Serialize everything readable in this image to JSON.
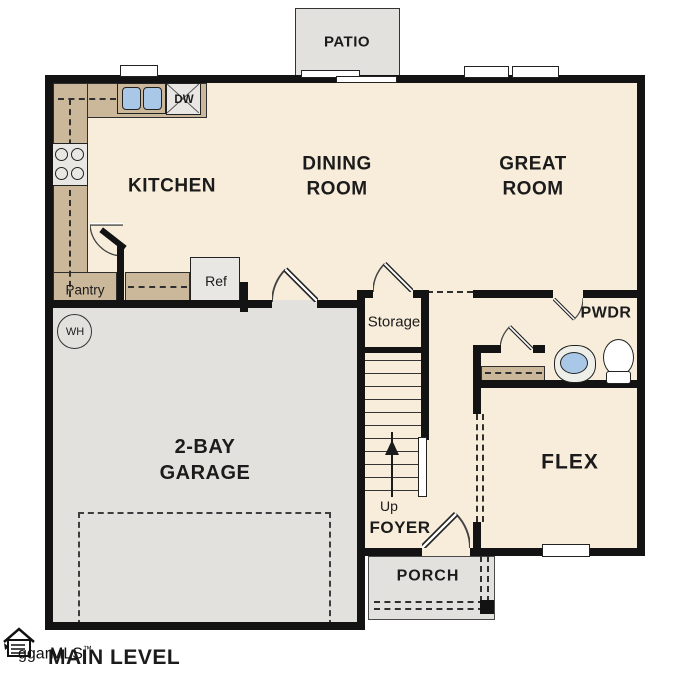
{
  "footer": {
    "title": "MAIN LEVEL",
    "brand": "ggarMLS",
    "brand_tm": "™"
  },
  "rooms": {
    "patio": "PATIO",
    "kitchen": "KITCHEN",
    "dining_room": "DINING\nROOM",
    "great_room": "GREAT\nROOM",
    "garage": "2-BAY\nGARAGE",
    "flex": "FLEX",
    "foyer": "FOYER",
    "porch": "PORCH",
    "powder_room": "PWDR",
    "storage": "Storage",
    "pantry": "Pantry"
  },
  "fixtures": {
    "dishwasher": "DW",
    "refrigerator": "Ref",
    "water_heater": "WH",
    "stairs_direction": "Up"
  },
  "colors": {
    "wall": "#131313",
    "floor": "#f7edda",
    "counter": "#cbb79a",
    "concrete": "#e2e1dd",
    "sink_water": "#a9c7e6"
  }
}
